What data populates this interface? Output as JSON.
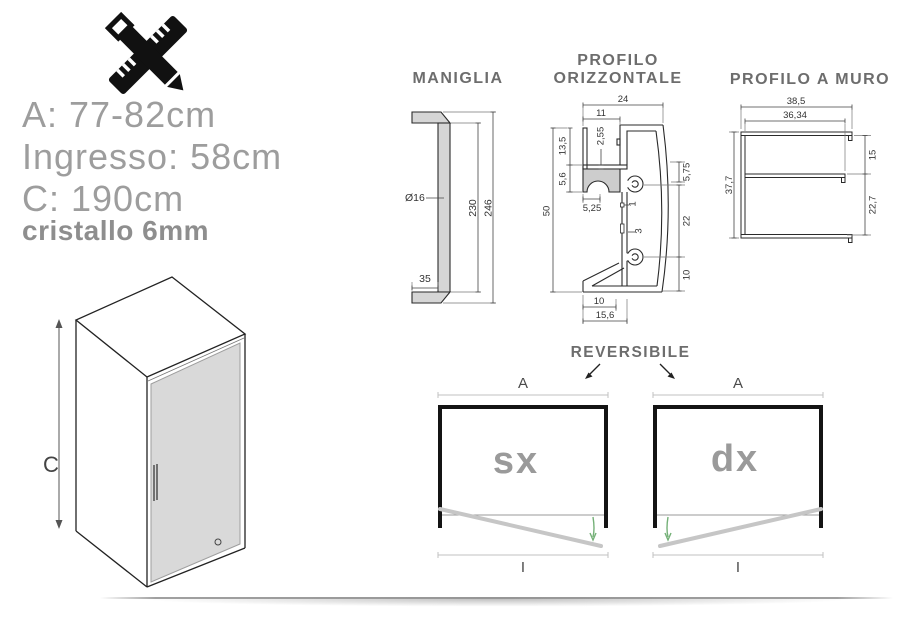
{
  "specs": {
    "line_a": "A: 77-82cm",
    "line_ingresso": "Ingresso: 58cm",
    "line_c": "C: 190cm",
    "line_glass": "cristallo 6mm"
  },
  "box3d": {
    "height_label": "C"
  },
  "maniglia": {
    "title": "MANIGLIA",
    "dims": {
      "diameter": "Ø16",
      "inner_height": "230",
      "outer_height": "246",
      "arm_depth": "35"
    }
  },
  "profilo_orizzontale": {
    "title_line1": "PROFILO",
    "title_line2": "ORIZZONTALE",
    "dims": {
      "top_width": "24",
      "upper_width": "11",
      "shelf_thickness": "2,55",
      "fin_height": "13,5",
      "block_height": "5,6",
      "total_height": "50",
      "arch_width": "5,25",
      "notch_small": "1",
      "notch_large": "3",
      "right_upper": "5,75",
      "right_middle": "22",
      "right_lower": "10",
      "bottom_inner": "10",
      "bottom_outer": "15,6"
    }
  },
  "profilo_muro": {
    "title": "PROFILO A MURO",
    "dims": {
      "outer_width": "38,5",
      "inner_width": "36,34",
      "upper_height": "15",
      "total_height": "37,7",
      "lower_height": "22,7"
    }
  },
  "reversibile": {
    "title": "REVERSIBILE",
    "left_door": {
      "label": "sx",
      "width_label": "A",
      "entry_label": "I"
    },
    "right_door": {
      "label": "dx",
      "width_label": "A",
      "entry_label": "I"
    }
  },
  "colors": {
    "heading": "#6d6d6d",
    "spec_text": "#9d9d9d",
    "line": "#2a2a2a",
    "gray_fill": "#cdcdcd",
    "glass": "#d9d9d9",
    "door_label": "#9a9a9a",
    "swing_green": "#74b077",
    "door_gray": "#c6c6c6"
  }
}
